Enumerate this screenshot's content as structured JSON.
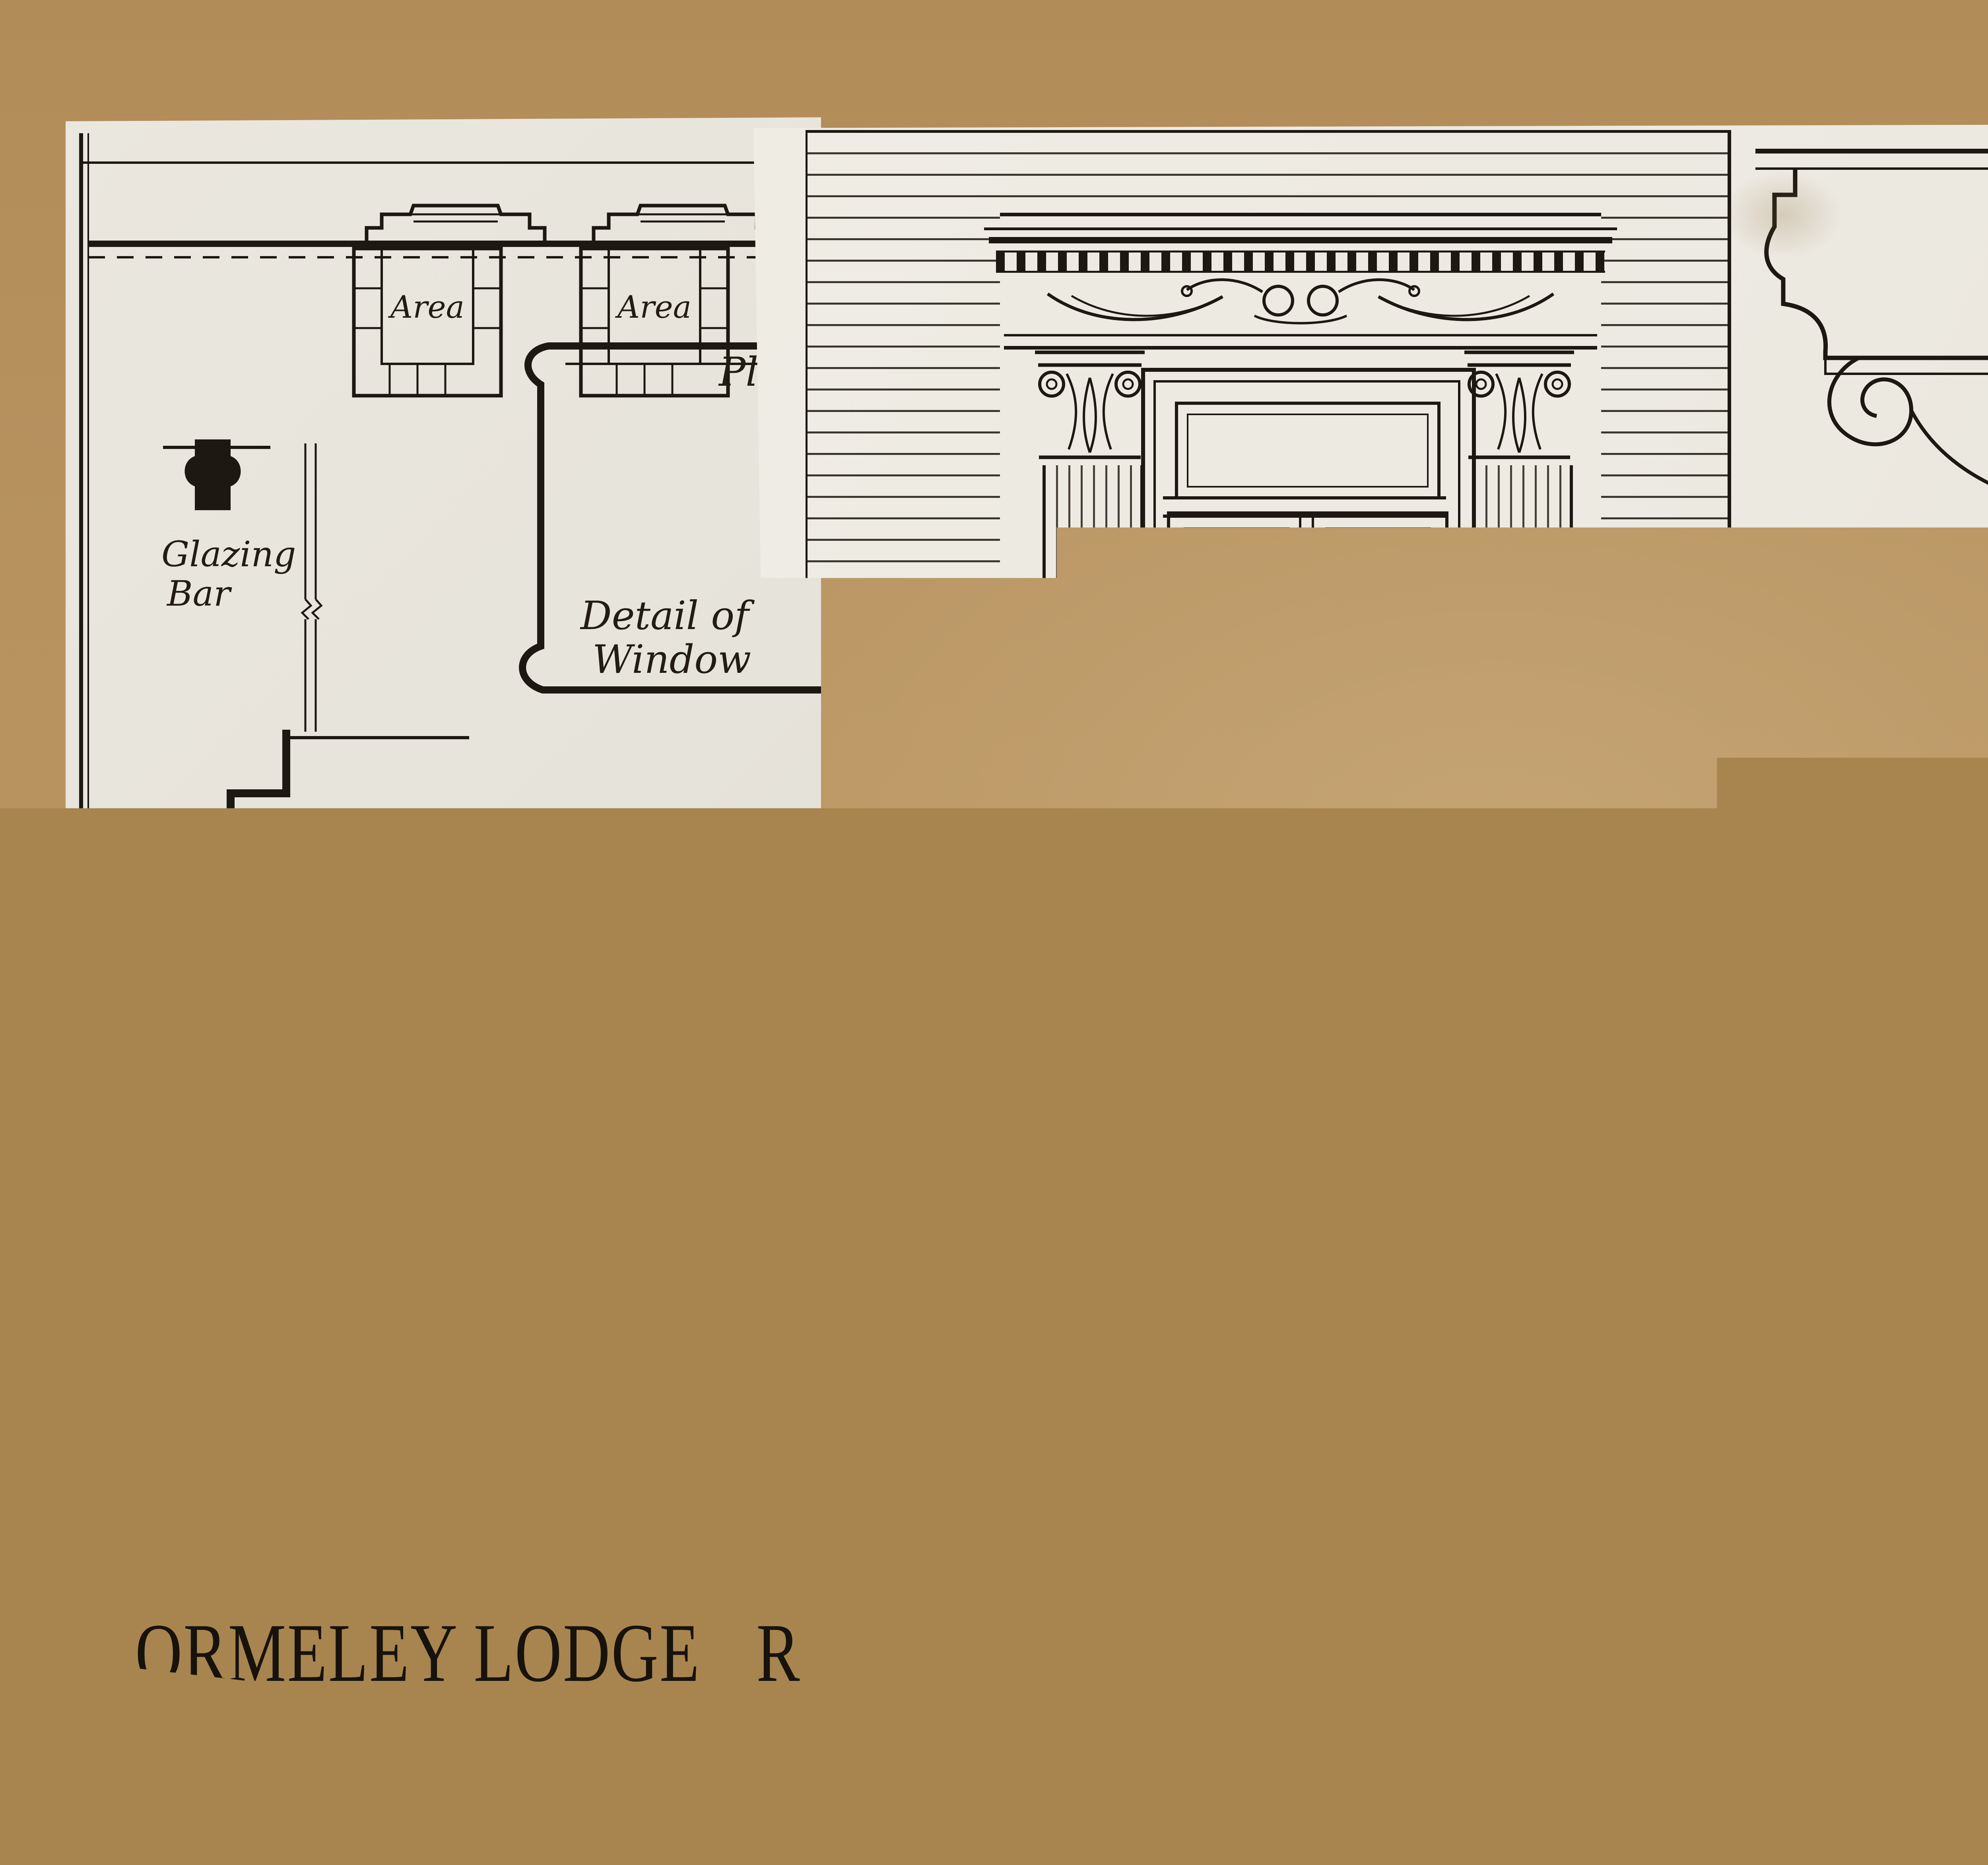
{
  "annotation": {
    "code": "3-C"
  },
  "left_sheet": {
    "areas": [
      "Area",
      "Area"
    ],
    "plan_top": "Plan",
    "glazing_bar": [
      "Glazing",
      "Bar"
    ],
    "detail_of_window": [
      "Detail of",
      "Window"
    ],
    "brick_string_second": [
      "Brick String",
      "at Second",
      "Floor Level"
    ],
    "brick_string_first": [
      "Brick String",
      "at First",
      "Floor Level"
    ],
    "window_scale": {
      "title": "Scale for W",
      "ticks": [
        "In",
        "1",
        "½",
        "0"
      ]
    },
    "window_partial": "Wind",
    "plan_bottom": "Plan",
    "title": "ORMELEY LODGE",
    "title_partial": "R"
  },
  "right_sheet": {
    "labels": {
      "cornice_to_door": [
        "Cornice",
        "to Door"
      ],
      "nosing_to_steps": [
        "Nosing to",
        "Steps"
      ],
      "section": "Section",
      "original_ground_line": "Original Ground Line",
      "elevation": "Elevation",
      "panel_mould": "Panel Mould",
      "architrave": "Architrave",
      "pilaster": "Pilaster",
      "pilaster_base": [
        "Pilaster",
        "Base"
      ]
    },
    "dimensions": {
      "vertical": "6⅝",
      "horizontal": "3⅝"
    },
    "details_scale": {
      "title": "Scale for Details",
      "ticks": [
        "In",
        "1",
        "½",
        "0",
        "1",
        "2",
        "3",
        "4",
        "5",
        "Ins"
      ]
    },
    "title": "ORMELEY LODGE",
    "subtitle": "Entrance Door",
    "main_scale": {
      "title": "Scale",
      "ticks": [
        "Ins",
        "12",
        "6",
        "0",
        "1",
        "2",
        "3",
        "4",
        "5",
        "6",
        "7",
        "8 feet."
      ]
    }
  },
  "colors": {
    "kraft": "#b5905d",
    "paper_left": "#e8e5dc",
    "paper_right": "#edeae2",
    "ink": "#1d1812",
    "pencil": "#6e7267"
  }
}
